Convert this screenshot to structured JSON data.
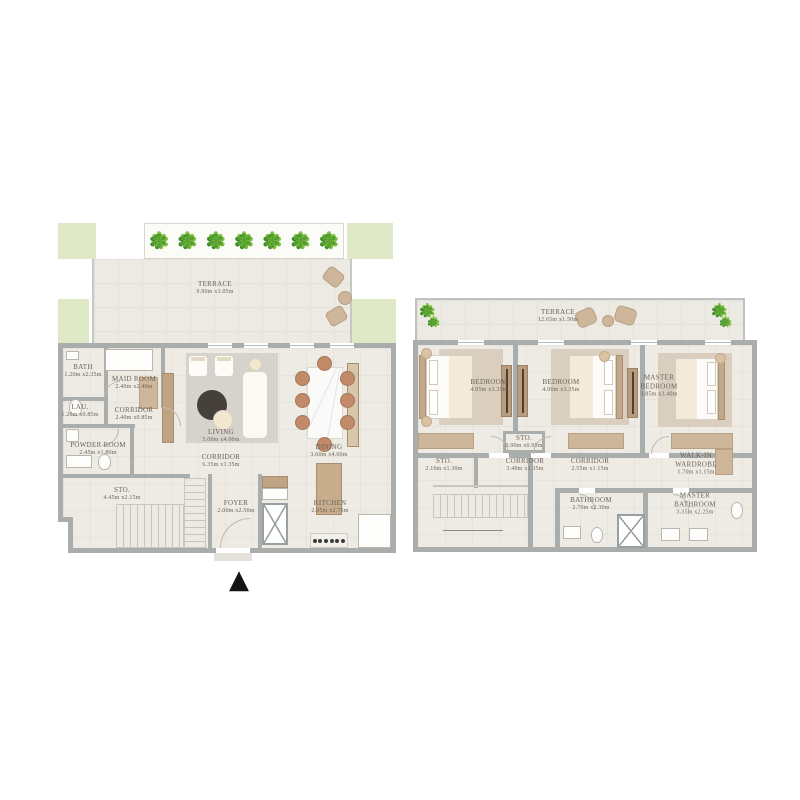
{
  "colors": {
    "wall": "#a9adac",
    "floor": "#edebe4",
    "terrace_floor": "#eceae2",
    "planter_green": "#dfe9c8",
    "plant_green": "#56a032",
    "wood": "#c0a585",
    "terracotta_chair": "#c28a68",
    "rug_gray": "#d5d3cb",
    "rug_beige": "#dacfbf",
    "label_text": "#6a635a",
    "marker_black": "#141414"
  },
  "icons": {
    "plant": "✽"
  },
  "marker": {
    "entry_symbol": "▲"
  },
  "floor1": {
    "terrace": {
      "name": "TERRACE",
      "dims": "9.90m x3.05m"
    },
    "rooms": [
      {
        "name": "BATH",
        "dims": "1.20m x2.35m"
      },
      {
        "name": "MAID ROOM",
        "dims": "2.40m x2.40m"
      },
      {
        "name": "LAU.",
        "dims": "1.20m x0.85m"
      },
      {
        "name": "CORRIDOR",
        "dims": "2.40m x0.85m"
      },
      {
        "name": "POWDER ROOM",
        "dims": "2.45m x1.80m"
      },
      {
        "name": "STO.",
        "dims": "4.45m x2.15m"
      },
      {
        "name": "LIVING",
        "dims": "5.00m x4.00m"
      },
      {
        "name": "CORRIDOR",
        "dims": "6.35m x1.35m"
      },
      {
        "name": "DINING",
        "dims": "3.60m x4.60m"
      },
      {
        "name": "FOYER",
        "dims": "2.00m x2.50m"
      },
      {
        "name": "KITCHEN",
        "dims": "2.95m x2.75m"
      }
    ]
  },
  "floor2": {
    "terrace": {
      "name": "TERRACE",
      "dims": "12.65m x1.50m"
    },
    "rooms": [
      {
        "name": "BEDROOM",
        "dims": "4.05m x3.35m"
      },
      {
        "name": "BEDROOM",
        "dims": "4.00m x3.35m"
      },
      {
        "name": "MASTER BEDROOM",
        "dims": "3.85m x3.40m"
      },
      {
        "name": "STO.",
        "dims": "0.90m x0.95m"
      },
      {
        "name": "STO.",
        "dims": "2.10m x1.30m"
      },
      {
        "name": "CORRIDOR",
        "dims": "3.40m x1.35m"
      },
      {
        "name": "CORRIDOR",
        "dims": "2.55m x1.15m"
      },
      {
        "name": "WALK-IN WARDROBE",
        "dims": "1.70m x1.15m"
      },
      {
        "name": "BATHROOM",
        "dims": "2.70m x2.30m"
      },
      {
        "name": "MASTER BATHROOM",
        "dims": "3.35m x2.25m"
      }
    ]
  }
}
